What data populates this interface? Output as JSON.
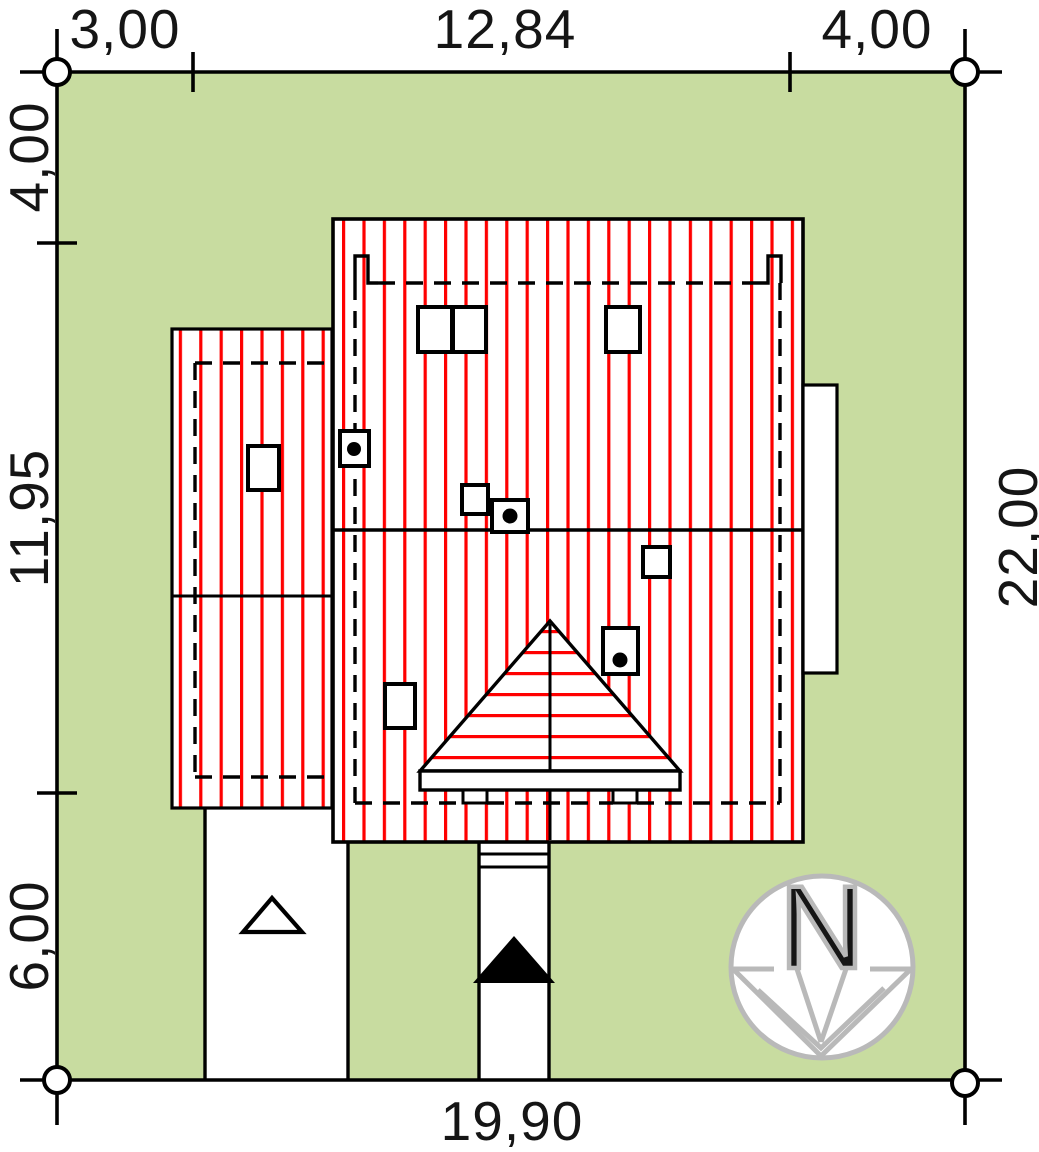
{
  "dimensions": {
    "top": [
      "3,00",
      "12,84",
      "4,00"
    ],
    "left": [
      "4,00",
      "11,95",
      "6,00"
    ],
    "right": [
      "22,00"
    ],
    "bottom": [
      "19,90"
    ]
  },
  "north_arrow": {
    "letter": "N"
  },
  "colors": {
    "plot_green": "#c8dca0",
    "hatch_red": "#ff0000",
    "line_black": "#000000",
    "north_gray": "#b9b9b9"
  }
}
